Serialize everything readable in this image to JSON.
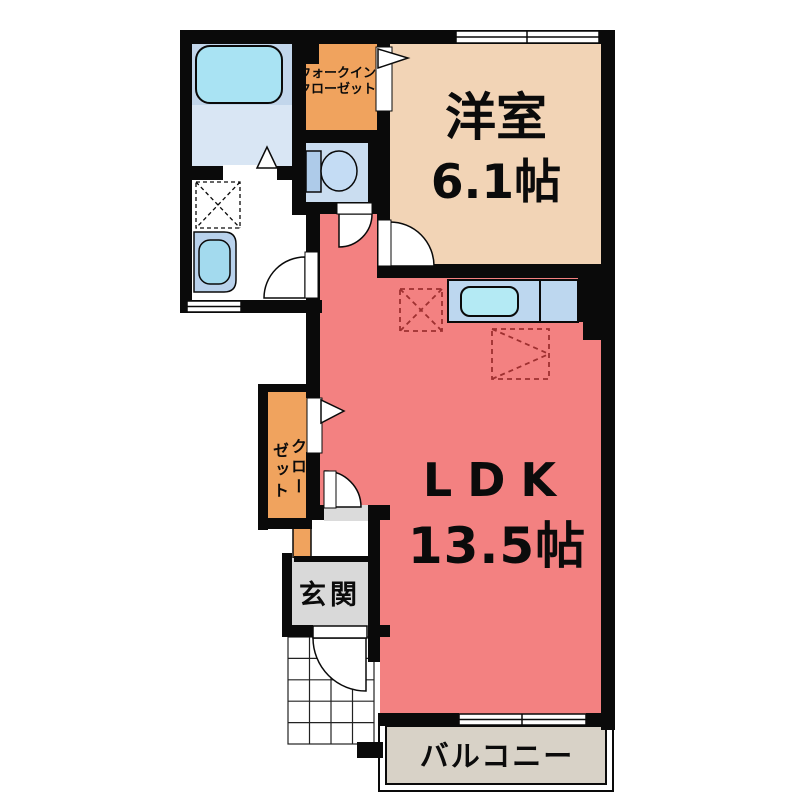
{
  "rooms": {
    "western_room": {
      "label": "洋室",
      "size": "6.1帖",
      "color": "#F2D4B6"
    },
    "ldk": {
      "label": "LDK",
      "size": "13.5帖",
      "color": "#F38181"
    },
    "walk_in_closet": {
      "label_line1": "ウォークイン",
      "label_line2": "クローゼット",
      "color": "#F0A35E"
    },
    "closet": {
      "label_col_right": "クロー",
      "label_col_left": "ゼット",
      "color": "#F0A35E"
    },
    "entrance": {
      "label": "玄関",
      "color": "#D9D9D9"
    },
    "balcony": {
      "label": "バルコニー",
      "color": "#D8D2C7"
    },
    "toilet": {
      "color": "#CADDF0"
    },
    "washroom": {
      "color": "#FFFFFF"
    }
  },
  "colors": {
    "wall": "#0a0a0a",
    "bath_platform": "#C2D6EB",
    "bath_floor": "#D9E6F4",
    "bathtub": "#A9E3F3",
    "toilet_tank": "#AECBE9",
    "toilet_bowl": "#C4DCF4",
    "washbasin_outer": "#B9D2EC",
    "washbasin_bowl": "#A3DAEE",
    "kitchen_counter": "#BDD7EF",
    "kitchen_sink": "#B4EAF4",
    "threshold": "#DBDBDB",
    "dashed_red": "#9E3030"
  },
  "icons": {
    "bathtub": "bathtub-icon",
    "toilet": "toilet-icon",
    "washbasin": "washbasin-icon",
    "kitchen_sink": "kitchen-sink-icon",
    "washing_machine_space": "washing-machine-space-icon",
    "refrigerator_space": "refrigerator-space-icon",
    "cupboard_space": "cupboard-space-icon"
  }
}
